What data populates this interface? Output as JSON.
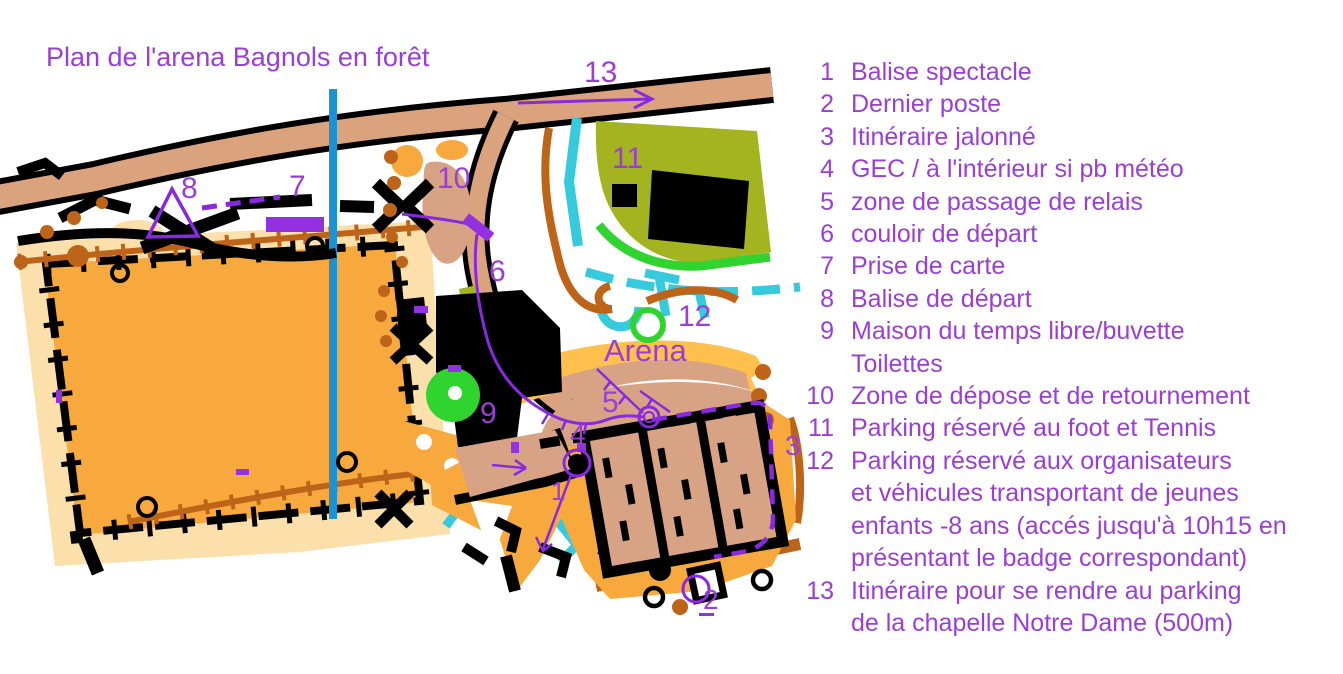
{
  "title": "Plan de l'arena Bagnols en forêt",
  "colors": {
    "purple": "#9B3ED6",
    "route": "#8829E0",
    "violet": "#9330E0",
    "road": "#DBA37D",
    "tan": "#D8A384",
    "orange": "#F7A93E",
    "borange": "#FFC04D",
    "pale": "#FBE0AC",
    "olive": "#A4B320",
    "green": "#2FD42F",
    "cyan": "#35CADC",
    "blue": "#1B93D2",
    "brown": "#BE6418"
  },
  "map": {
    "labels": [
      {
        "id": "13",
        "text": "13",
        "x": 584,
        "y": 82,
        "size": 30
      },
      {
        "id": "11",
        "text": "11",
        "x": 612,
        "y": 168,
        "size": 30
      },
      {
        "id": "10",
        "text": "10",
        "x": 437,
        "y": 188,
        "size": 30
      },
      {
        "id": "8",
        "text": "8",
        "x": 181,
        "y": 198,
        "size": 30
      },
      {
        "id": "7",
        "text": "7",
        "x": 289,
        "y": 196,
        "size": 30
      },
      {
        "id": "6",
        "text": "6",
        "x": 489,
        "y": 281,
        "size": 30
      },
      {
        "id": "12",
        "text": "12",
        "x": 678,
        "y": 326,
        "size": 30
      },
      {
        "id": "arena",
        "text": "Arena",
        "x": 604,
        "y": 361,
        "size": 31
      },
      {
        "id": "9",
        "text": "9",
        "x": 480,
        "y": 423,
        "size": 30
      },
      {
        "id": "5",
        "text": "5",
        "x": 602,
        "y": 412,
        "size": 30
      },
      {
        "id": "4",
        "text": "4",
        "x": 570,
        "y": 444,
        "size": 28
      },
      {
        "id": "1",
        "text": "1",
        "x": 551,
        "y": 500,
        "size": 26
      },
      {
        "id": "2",
        "text": "2",
        "x": 703,
        "y": 609,
        "size": 28
      },
      {
        "id": "3",
        "text": "3",
        "x": 785,
        "y": 455,
        "size": 28
      }
    ]
  },
  "legend": {
    "items": [
      {
        "num": "1",
        "lines": [
          "Balise spectacle"
        ]
      },
      {
        "num": "2",
        "lines": [
          "Dernier poste"
        ]
      },
      {
        "num": "3",
        "lines": [
          "Itinéraire jalonné"
        ]
      },
      {
        "num": "4",
        "lines": [
          "GEC / à l'intérieur si pb météo"
        ]
      },
      {
        "num": "5",
        "lines": [
          "zone de passage de relais"
        ]
      },
      {
        "num": "6",
        "lines": [
          "couloir de départ"
        ]
      },
      {
        "num": "7",
        "lines": [
          "Prise de carte"
        ]
      },
      {
        "num": "8",
        "lines": [
          "Balise de départ"
        ]
      },
      {
        "num": "9",
        "lines": [
          "Maison du temps libre/buvette",
          "Toilettes"
        ]
      },
      {
        "num": "10",
        "lines": [
          "Zone de dépose et de retournement"
        ]
      },
      {
        "num": "11",
        "lines": [
          "Parking réservé au foot et Tennis"
        ]
      },
      {
        "num": "12",
        "lines": [
          "Parking réservé aux organisateurs",
          "et véhicules transportant de jeunes",
          "enfants -8 ans (accés jusqu'à 10h15 en",
          "présentant le badge correspondant)"
        ]
      },
      {
        "num": "13",
        "lines": [
          "Itinéraire pour se rendre au parking",
          "de la chapelle Notre Dame (500m)"
        ]
      }
    ]
  }
}
